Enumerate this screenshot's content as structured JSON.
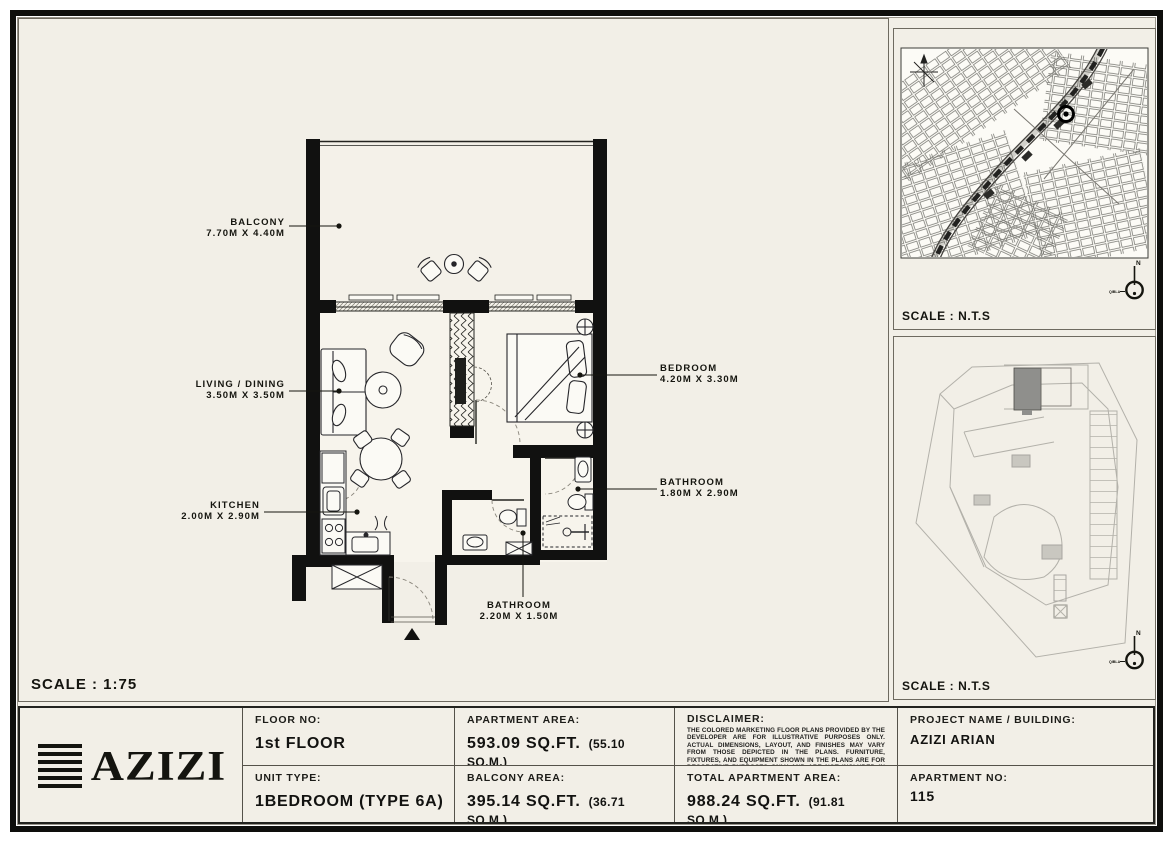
{
  "plan": {
    "scale_label": "SCALE : 1:75",
    "rooms": [
      {
        "name": "BALCONY",
        "dims": "7.70M X 4.40M"
      },
      {
        "name": "LIVING / DINING",
        "dims": "3.50M X 3.50M"
      },
      {
        "name": "KITCHEN",
        "dims": "2.00M X 2.90M"
      },
      {
        "name": "BEDROOM",
        "dims": "4.20M X 3.30M"
      },
      {
        "name": "BATHROOM",
        "dims": "1.80M X 2.90M"
      },
      {
        "name": "BATHROOM",
        "dims": "2.20M X 1.50M"
      }
    ]
  },
  "maps": {
    "location": {
      "scale_label": "SCALE : N.T.S",
      "compass_north": "N",
      "compass_qibla": "QIBLA"
    },
    "site": {
      "scale_label": "SCALE : N.T.S",
      "compass_north": "N",
      "compass_qibla": "QIBLA"
    }
  },
  "logo": {
    "text": "AZIZI"
  },
  "table": {
    "floor_label": "FLOOR NO:",
    "floor_value": "1st FLOOR",
    "unit_label": "UNIT TYPE:",
    "unit_value": "1BEDROOM (TYPE 6A)",
    "apartment_area_label": "APARTMENT AREA:",
    "apartment_area_value": "593.09 SQ.FT.",
    "apartment_area_metric": "(55.10 SQ.M.)",
    "balcony_area_label": "BALCONY AREA:",
    "balcony_area_value": "395.14 SQ.FT.",
    "balcony_area_metric": "(36.71 SQ.M.)",
    "disclaimer_label": "DISCLAIMER:",
    "disclaimer_text": "THE COLORED MARKETING FLOOR PLANS PROVIDED BY THE DEVELOPER ARE FOR ILLUSTRATIVE PURPOSES ONLY. ACTUAL DIMENSIONS, LAYOUT, AND FINISHES MAY VARY FROM THOSE DEPICTED IN THE PLANS. FURNITURE, FIXTURES, AND EQUIPMENT SHOWN IN THE PLANS ARE FOR DECORATIVE PURPOSES ONLY AND ARE NOT INCLUDED IN THE PURCHASE OR LEASE OF THE PROPERTY. THE DEVELOPER RESERVES THE RIGHT TO MAKE MODIFICATIONS, REVISIONS, AND CHANGES TO THE FLOOR PLANS, SPECIFICATIONS, AND FEATURES WITHOUT PRIOR NOTICE.",
    "total_area_label": "TOTAL APARTMENT AREA:",
    "total_area_value": "988.24 SQ.FT.",
    "total_area_metric": "(91.81 SQ.M.)",
    "project_label": "PROJECT NAME / BUILDING:",
    "project_value": "AZIZI ARIAN",
    "apartment_no_label": "APARTMENT NO:",
    "apartment_no_value": "115"
  }
}
